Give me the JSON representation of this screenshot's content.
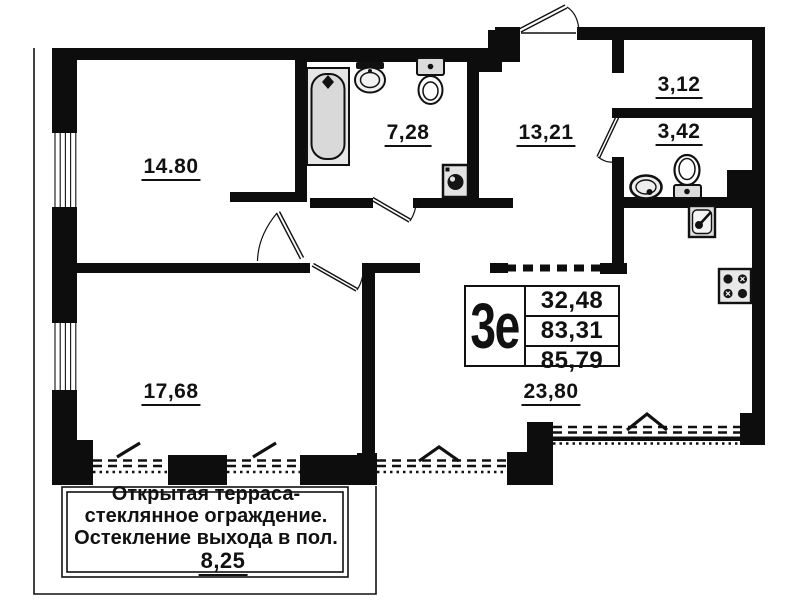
{
  "floor_plan": {
    "unit": {
      "type_label": "3е",
      "area_rows": [
        "32,48",
        "83,31",
        "85,79"
      ]
    },
    "rooms": [
      {
        "id": "bedroom",
        "area": "14.80"
      },
      {
        "id": "bathroom",
        "area": "7,28"
      },
      {
        "id": "hallway",
        "area": "13,21"
      },
      {
        "id": "storage",
        "area": "3,12"
      },
      {
        "id": "wc",
        "area": "3,42"
      },
      {
        "id": "living-room",
        "area": "17,68"
      },
      {
        "id": "kitchen-living",
        "area": "23,80"
      }
    ],
    "terrace": {
      "note_lines": [
        "Открытая терраса-",
        "стеклянное ограждение.",
        "Остекление выхода в пол."
      ],
      "area": "8,25"
    },
    "colors": {
      "wall": "#0d0d0d",
      "fixture_fill": "#e3e3e3",
      "background": "#ffffff"
    }
  }
}
